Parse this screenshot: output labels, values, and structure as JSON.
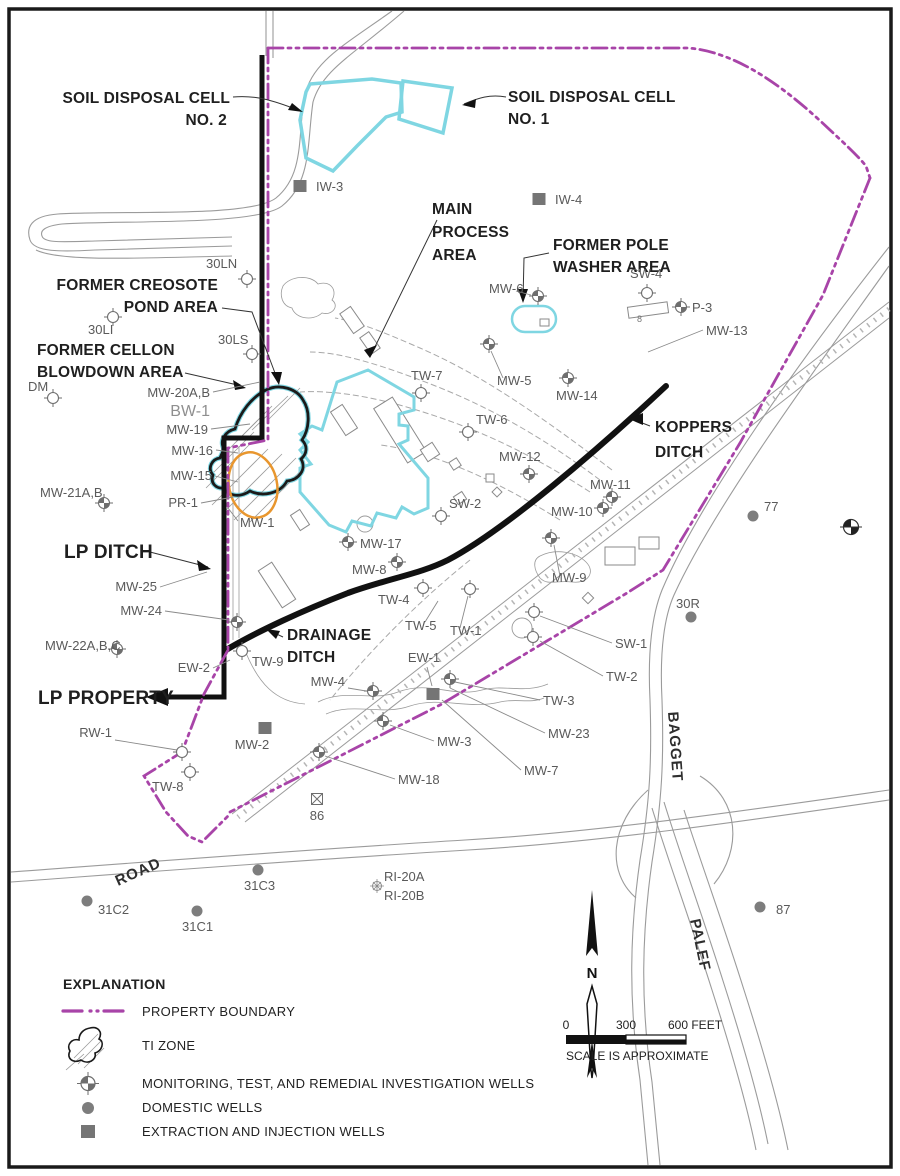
{
  "colors": {
    "boundary": "#A844A8",
    "zone_cyan": "#7FD6E2",
    "ti_orange": "#E8962E",
    "well_gray": "#6E6E6E",
    "line_gray": "#9B9B9B",
    "ink": "#1A1A1A"
  },
  "area_labels": {
    "soil2": [
      "SOIL DISPOSAL CELL",
      "NO. 2"
    ],
    "soil1": [
      "SOIL DISPOSAL CELL",
      "NO. 1"
    ],
    "main_process": [
      "MAIN",
      "PROCESS",
      "AREA"
    ],
    "pole_washer": [
      "FORMER POLE",
      "WASHER AREA"
    ],
    "creosote": [
      "FORMER CREOSOTE",
      "POND AREA"
    ],
    "cellon": [
      "FORMER CELLON",
      "BLOWDOWN AREA"
    ],
    "koppers": [
      "KOPPERS",
      "DITCH"
    ],
    "lp_ditch": [
      "LP DITCH"
    ],
    "drainage": [
      "DRAINAGE",
      "DITCH"
    ],
    "lp_property": [
      "LP PROPERTY"
    ]
  },
  "road_labels": [
    {
      "text": "ROAD",
      "x": 118,
      "y": 886,
      "rot": -24
    },
    {
      "text": "BAGGET",
      "x": 668,
      "y": 712,
      "rot": 86
    },
    {
      "text": "PALEF",
      "x": 690,
      "y": 920,
      "rot": 78
    }
  ],
  "misc": {
    "eight": "8"
  },
  "north": {
    "label": "N"
  },
  "scale": {
    "t0": "0",
    "t300": "300",
    "t600": "600 FEET",
    "note": "SCALE IS APPROXIMATE"
  },
  "legend": {
    "title": "EXPLANATION",
    "items": [
      {
        "symbol": "property-boundary-line",
        "label": "PROPERTY BOUNDARY"
      },
      {
        "symbol": "ti-zone-patch",
        "label": "TI ZONE"
      },
      {
        "symbol": "monitoring-well-icon",
        "label": "MONITORING, TEST, AND REMEDIAL INVESTIGATION WELLS"
      },
      {
        "symbol": "domestic-well-icon",
        "label": "DOMESTIC WELLS"
      },
      {
        "symbol": "extraction-well-icon",
        "label": "EXTRACTION AND INJECTION WELLS"
      }
    ]
  },
  "wells": [
    {
      "id": "IW-3",
      "t": "ext",
      "s": [
        300,
        186
      ],
      "l": [
        316,
        191
      ],
      "a": "start"
    },
    {
      "id": "IW-4",
      "t": "ext",
      "s": [
        539,
        199
      ],
      "l": [
        555,
        204
      ],
      "a": "start"
    },
    {
      "id": "30LN",
      "t": "monO",
      "s": [
        247,
        279
      ],
      "l": [
        206,
        268
      ],
      "a": "start"
    },
    {
      "id": "30LI",
      "t": "monO",
      "s": [
        113,
        317
      ],
      "l": [
        88,
        334
      ],
      "a": "start"
    },
    {
      "id": "30LS",
      "t": "monO",
      "s": [
        252,
        354
      ],
      "l": [
        218,
        344
      ],
      "a": "start"
    },
    {
      "id": "DM",
      "t": "monO",
      "s": [
        53,
        398
      ],
      "l": [
        28,
        391
      ],
      "a": "start"
    },
    {
      "id": "MW-20A,B",
      "t": "none",
      "l": [
        210,
        397
      ],
      "a": "end",
      "ld": [
        [
          213,
          392
        ],
        [
          260,
          382
        ]
      ]
    },
    {
      "id": "BW-1",
      "t": "none",
      "l": [
        210,
        416
      ],
      "a": "end",
      "big": 1
    },
    {
      "id": "MW-19",
      "t": "none",
      "l": [
        208,
        434
      ],
      "a": "end",
      "ld": [
        [
          211,
          429
        ],
        [
          250,
          424
        ]
      ]
    },
    {
      "id": "MW-16",
      "t": "none",
      "l": [
        213,
        455
      ],
      "a": "end",
      "ld": [
        [
          216,
          450
        ],
        [
          238,
          453
        ]
      ]
    },
    {
      "id": "MW-15",
      "t": "none",
      "l": [
        212,
        480
      ],
      "a": "end",
      "ld": [
        [
          215,
          476
        ],
        [
          238,
          482
        ]
      ]
    },
    {
      "id": "MW-21A,B",
      "t": "mon",
      "s": [
        104,
        503
      ],
      "l": [
        40,
        497
      ],
      "a": "start"
    },
    {
      "id": "PR-1",
      "t": "none",
      "l": [
        198,
        507
      ],
      "a": "end",
      "ld": [
        [
          201,
          503
        ],
        [
          233,
          497
        ]
      ]
    },
    {
      "id": "MW-1",
      "t": "none",
      "l": [
        240,
        527
      ],
      "a": "start",
      "ld": [
        [
          238,
          521
        ],
        [
          228,
          508
        ]
      ]
    },
    {
      "id": "MW-25",
      "t": "none",
      "l": [
        157,
        591
      ],
      "a": "end",
      "ld": [
        [
          160,
          587
        ],
        [
          207,
          572
        ]
      ]
    },
    {
      "id": "MW-24",
      "t": "mon",
      "s": [
        237,
        622
      ],
      "l": [
        162,
        615
      ],
      "a": "end",
      "ld": [
        [
          165,
          611
        ],
        [
          229,
          620
        ]
      ]
    },
    {
      "id": "MW-22A,B,C",
      "t": "mon",
      "s": [
        117,
        649
      ],
      "l": [
        45,
        650
      ],
      "a": "start"
    },
    {
      "id": "EW-2",
      "t": "none",
      "l": [
        210,
        672
      ],
      "a": "end",
      "ld": [
        [
          213,
          668
        ],
        [
          230,
          660
        ]
      ]
    },
    {
      "id": "TW-9",
      "t": "monO",
      "s": [
        242,
        651
      ],
      "l": [
        252,
        666
      ],
      "a": "start"
    },
    {
      "id": "RW-1",
      "t": "monO",
      "s": [
        182,
        752
      ],
      "l": [
        112,
        737
      ],
      "a": "end",
      "ld": [
        [
          115,
          740
        ],
        [
          177,
          750
        ]
      ]
    },
    {
      "id": "TW-8",
      "t": "monO",
      "s": [
        190,
        772
      ],
      "l": [
        152,
        791
      ],
      "a": "start"
    },
    {
      "id": "MW-2",
      "t": "ext",
      "s": [
        265,
        728
      ],
      "l": [
        252,
        749
      ],
      "a": "middle"
    },
    {
      "id": "86",
      "t": "x86",
      "s": [
        317,
        799
      ],
      "l": [
        317,
        820
      ],
      "a": "middle"
    },
    {
      "id": "MW-4",
      "t": "mon",
      "s": [
        373,
        691
      ],
      "l": [
        345,
        686
      ],
      "a": "end",
      "ld": [
        [
          348,
          688
        ],
        [
          366,
          691
        ]
      ]
    },
    {
      "id": "EW-1",
      "t": "ext",
      "s": [
        433,
        694
      ],
      "l": [
        424,
        662
      ],
      "a": "middle",
      "ld": [
        [
          427,
          667
        ],
        [
          432,
          686
        ]
      ]
    },
    {
      "id": "MW-3",
      "t": "mon",
      "s": [
        383,
        721
      ],
      "l": [
        437,
        746
      ],
      "a": "start",
      "ld": [
        [
          434,
          741
        ],
        [
          390,
          725
        ]
      ]
    },
    {
      "id": "MW-18",
      "t": "mon",
      "s": [
        319,
        752
      ],
      "l": [
        398,
        784
      ],
      "a": "start",
      "ld": [
        [
          395,
          779
        ],
        [
          325,
          756
        ]
      ]
    },
    {
      "id": "MW-23",
      "t": "none",
      "l": [
        548,
        738
      ],
      "a": "start",
      "ld": [
        [
          545,
          733
        ],
        [
          450,
          688
        ]
      ]
    },
    {
      "id": "MW-7",
      "t": "none",
      "l": [
        524,
        775
      ],
      "a": "start",
      "ld": [
        [
          521,
          770
        ],
        [
          442,
          700
        ]
      ]
    },
    {
      "id": "TW-3",
      "t": "none",
      "l": [
        543,
        705
      ],
      "a": "start",
      "ld": [
        [
          540,
          700
        ],
        [
          455,
          682
        ]
      ]
    },
    {
      "id": "SW-1",
      "t": "monO",
      "s": [
        534,
        612
      ],
      "l": [
        615,
        648
      ],
      "a": "start",
      "ld": [
        [
          612,
          643
        ],
        [
          540,
          616
        ]
      ]
    },
    {
      "id": "TW-2",
      "t": "monO",
      "s": [
        533,
        637
      ],
      "l": [
        606,
        681
      ],
      "a": "start",
      "ld": [
        [
          603,
          676
        ],
        [
          540,
          641
        ]
      ]
    },
    {
      "id": "TW-1",
      "t": "monO",
      "s": [
        470,
        589
      ],
      "l": [
        450,
        635
      ],
      "a": "start",
      "ld": [
        [
          460,
          628
        ],
        [
          468,
          596
        ]
      ]
    },
    {
      "id": "TW-4",
      "t": "monO",
      "s": [
        423,
        588
      ],
      "l": [
        378,
        604
      ],
      "a": "start"
    },
    {
      "id": "TW-5",
      "t": "none",
      "l": [
        405,
        630
      ],
      "a": "start",
      "ld": [
        [
          425,
          622
        ],
        [
          438,
          601
        ]
      ]
    },
    {
      "id": "MW-8",
      "t": "mon",
      "s": [
        397,
        562
      ],
      "l": [
        352,
        574
      ],
      "a": "start"
    },
    {
      "id": "MW-17",
      "t": "mon",
      "s": [
        348,
        542
      ],
      "l": [
        360,
        548
      ],
      "a": "start"
    },
    {
      "id": "SW-2",
      "t": "monO",
      "s": [
        441,
        516
      ],
      "l": [
        449,
        508
      ],
      "a": "start"
    },
    {
      "id": "MW-12",
      "t": "mon",
      "s": [
        529,
        474
      ],
      "l": [
        499,
        461
      ],
      "a": "start"
    },
    {
      "id": "MW-10",
      "t": "mon",
      "s": [
        603,
        508
      ],
      "l": [
        551,
        516
      ],
      "a": "start"
    },
    {
      "id": "MW-11",
      "t": "mon",
      "s": [
        612,
        497
      ],
      "l": [
        590,
        489
      ],
      "a": "start"
    },
    {
      "id": "MW-9",
      "t": "mon",
      "s": [
        551,
        538
      ],
      "l": [
        552,
        582
      ],
      "a": "start",
      "ld": [
        [
          560,
          576
        ],
        [
          554,
          545
        ]
      ]
    },
    {
      "id": "TW-6",
      "t": "monO",
      "s": [
        468,
        432
      ],
      "l": [
        476,
        424
      ],
      "a": "start"
    },
    {
      "id": "TW-7",
      "t": "monO",
      "s": [
        421,
        393
      ],
      "l": [
        411,
        380
      ],
      "a": "start"
    },
    {
      "id": "MW-5",
      "t": "mon",
      "s": [
        489,
        344
      ],
      "l": [
        497,
        385
      ],
      "a": "start",
      "ld": [
        [
          503,
          378
        ],
        [
          491,
          351
        ]
      ]
    },
    {
      "id": "MW-14",
      "t": "mon",
      "s": [
        568,
        378
      ],
      "l": [
        556,
        400
      ],
      "a": "start"
    },
    {
      "id": "MW-6",
      "t": "mon",
      "s": [
        538,
        296
      ],
      "l": [
        489,
        293
      ],
      "a": "start",
      "ld": [
        [
          516,
          291
        ],
        [
          531,
          295
        ]
      ]
    },
    {
      "id": "SW-4",
      "t": "monO",
      "s": [
        647,
        293
      ],
      "l": [
        630,
        278
      ],
      "a": "start"
    },
    {
      "id": "P-3",
      "t": "mon",
      "s": [
        681,
        307
      ],
      "l": [
        692,
        312
      ],
      "a": "start"
    },
    {
      "id": "MW-13",
      "t": "none",
      "l": [
        706,
        335
      ],
      "a": "start",
      "ld": [
        [
          703,
          330
        ],
        [
          648,
          352
        ]
      ]
    },
    {
      "id": "77",
      "t": "dom",
      "s": [
        753,
        516
      ],
      "l": [
        764,
        511
      ],
      "a": "start"
    },
    {
      "id": "30R",
      "t": "dom",
      "s": [
        691,
        617
      ],
      "l": [
        676,
        608
      ],
      "a": "start"
    },
    {
      "id": "87",
      "t": "dom",
      "s": [
        760,
        907
      ],
      "l": [
        776,
        914
      ],
      "a": "start"
    },
    {
      "id": "31C2",
      "t": "dom",
      "s": [
        87,
        901
      ],
      "l": [
        98,
        914
      ],
      "a": "start"
    },
    {
      "id": "31C1",
      "t": "dom",
      "s": [
        197,
        911
      ],
      "l": [
        182,
        931
      ],
      "a": "start"
    },
    {
      "id": "31C3",
      "t": "dom",
      "s": [
        258,
        870
      ],
      "l": [
        244,
        890
      ],
      "a": "start"
    },
    {
      "id": "RI-20A",
      "t": "ri",
      "s": [
        377,
        886
      ],
      "l": [
        384,
        881
      ],
      "a": "start"
    },
    {
      "id": "RI-20B",
      "t": "none",
      "l": [
        384,
        900
      ],
      "a": "start"
    },
    {
      "id": "",
      "t": "mon",
      "s": [
        450,
        679
      ]
    },
    {
      "id": "",
      "t": "bm",
      "s": [
        851,
        527
      ]
    }
  ]
}
